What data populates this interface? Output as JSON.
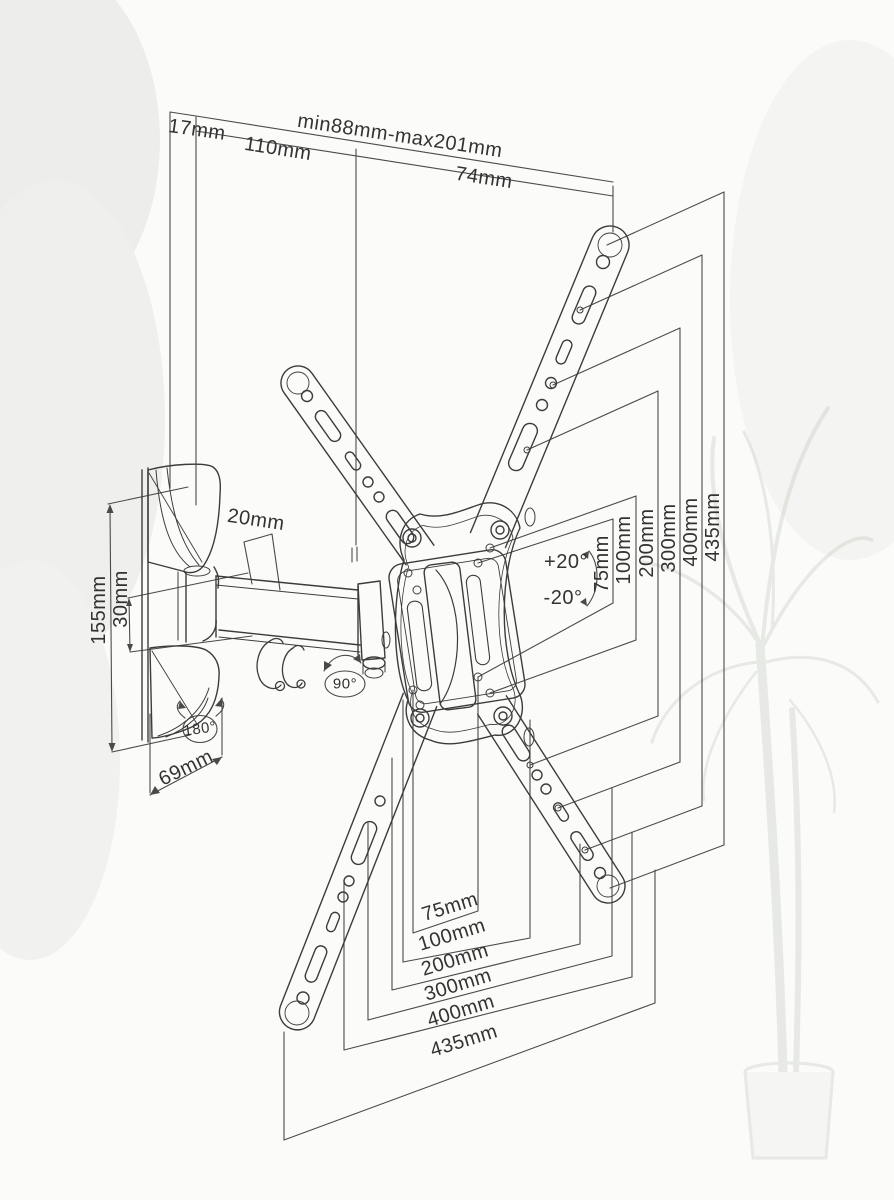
{
  "drawing_type": "technical-dimension-diagram",
  "subject": "articulating-tv-wall-mount-bracket",
  "colors": {
    "background": "#fbfbfa",
    "line": "#3c3c3c",
    "dimension_line": "#4a4a4a",
    "text": "#333333",
    "plant_decor": "#b9c0b2"
  },
  "dimensions": {
    "top_depth": [
      "17mm",
      "110mm",
      "min88mm-max201mm",
      "74mm"
    ],
    "left_side": [
      "155mm",
      "30mm",
      "20mm",
      "69mm"
    ],
    "swivel_angles": [
      "180°",
      "90°"
    ],
    "tilt_angles": [
      "+20°",
      "-20°"
    ],
    "vesa_vertical_right": [
      "75mm",
      "100mm",
      "200mm",
      "300mm",
      "400mm",
      "435mm"
    ],
    "vesa_horizontal_bottom": [
      "75mm",
      "100mm",
      "200mm",
      "300mm",
      "400mm",
      "435mm"
    ]
  },
  "labels": [
    {
      "name": "dim-label-17mm",
      "text": "17mm",
      "x": 197,
      "y": 130,
      "rot": 8,
      "size": 20
    },
    {
      "name": "dim-label-min-max",
      "text": "min88mm-max201mm",
      "x": 400,
      "y": 136,
      "rot": 8.5,
      "size": 20
    },
    {
      "name": "dim-label-110mm",
      "text": "110mm",
      "x": 278,
      "y": 149,
      "rot": 9,
      "size": 20
    },
    {
      "name": "dim-label-74mm",
      "text": "74mm",
      "x": 484,
      "y": 178,
      "rot": 8.5,
      "size": 20
    },
    {
      "name": "dim-label-155mm",
      "text": "155mm",
      "x": 99,
      "y": 610,
      "rot": -90,
      "size": 20
    },
    {
      "name": "dim-label-30mm",
      "text": "30mm",
      "x": 121,
      "y": 599,
      "rot": -90,
      "size": 20
    },
    {
      "name": "dim-label-20mm",
      "text": "20mm",
      "x": 256,
      "y": 520,
      "rot": 8.5,
      "size": 20
    },
    {
      "name": "dim-label-69mm",
      "text": "69mm",
      "x": 186,
      "y": 768,
      "rot": -26,
      "size": 20
    },
    {
      "name": "angle-label-180",
      "text": "180°",
      "x": 200,
      "y": 729,
      "rot": -8,
      "size": 15
    },
    {
      "name": "angle-label-90",
      "text": "90°",
      "x": 345,
      "y": 684,
      "rot": 0,
      "size": 15
    },
    {
      "name": "tilt-label-plus20",
      "text": "+20°",
      "x": 566,
      "y": 562,
      "rot": 0,
      "size": 20
    },
    {
      "name": "tilt-label-minus20",
      "text": "-20°",
      "x": 563,
      "y": 598,
      "rot": 0,
      "size": 20
    },
    {
      "name": "dim-label-right-75mm",
      "text": "75mm",
      "x": 602,
      "y": 564,
      "rot": -90,
      "size": 20
    },
    {
      "name": "dim-label-right-100mm",
      "text": "100mm",
      "x": 624,
      "y": 550,
      "rot": -90,
      "size": 20
    },
    {
      "name": "dim-label-right-200mm",
      "text": "200mm",
      "x": 647,
      "y": 543,
      "rot": -90,
      "size": 20
    },
    {
      "name": "dim-label-right-300mm",
      "text": "300mm",
      "x": 669,
      "y": 538,
      "rot": -90,
      "size": 20
    },
    {
      "name": "dim-label-right-400mm",
      "text": "400mm",
      "x": 691,
      "y": 532,
      "rot": -90,
      "size": 20
    },
    {
      "name": "dim-label-right-435mm",
      "text": "435mm",
      "x": 713,
      "y": 527,
      "rot": -90,
      "size": 20
    },
    {
      "name": "dim-label-bottom-75mm",
      "text": "75mm",
      "x": 450,
      "y": 907,
      "rot": -17,
      "size": 20
    },
    {
      "name": "dim-label-bottom-100mm",
      "text": "100mm",
      "x": 452,
      "y": 935,
      "rot": -17,
      "size": 20
    },
    {
      "name": "dim-label-bottom-200mm",
      "text": "200mm",
      "x": 455,
      "y": 960,
      "rot": -17,
      "size": 20
    },
    {
      "name": "dim-label-bottom-300mm",
      "text": "300mm",
      "x": 458,
      "y": 985,
      "rot": -17,
      "size": 20
    },
    {
      "name": "dim-label-bottom-400mm",
      "text": "400mm",
      "x": 461,
      "y": 1011,
      "rot": -17,
      "size": 20
    },
    {
      "name": "dim-label-bottom-435mm",
      "text": "435mm",
      "x": 464,
      "y": 1041,
      "rot": -17,
      "size": 20
    }
  ]
}
